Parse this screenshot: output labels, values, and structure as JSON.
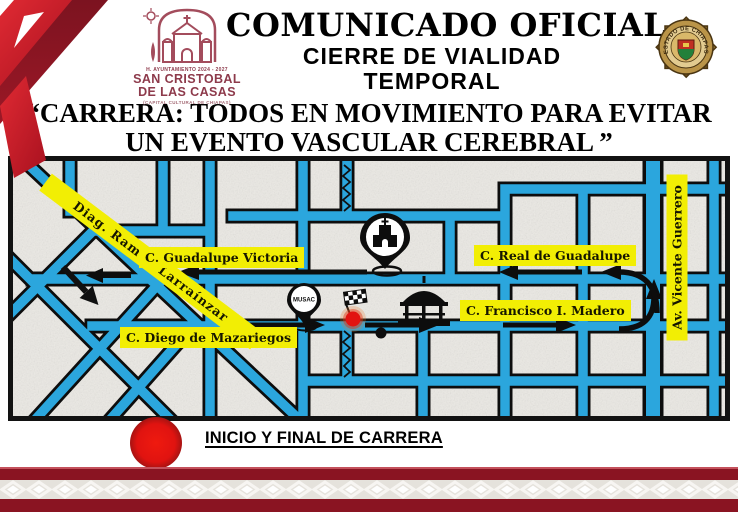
{
  "header": {
    "title": "COMUNICADO OFICIAL",
    "subtitle1": "CIERRE DE VIALIDAD",
    "subtitle2": "TEMPORAL"
  },
  "logo": {
    "admin": "H. AYUNTAMIENTO 2024 - 2027",
    "city1": "SAN CRISTOBAL",
    "city2": "DE LAS CASAS",
    "tagline": "(CAPITAL CULTURAL DE CHIAPAS)"
  },
  "badge": {
    "arc_text": "ESTADO DE CHIAPAS"
  },
  "event": {
    "line1": "“CARRERA: TODOS EN MOVIMIENTO PARA EVITAR",
    "line2": "UN EVENTO VASCULAR CEREBRAL ”"
  },
  "map": {
    "labels": {
      "larrainzar": "Diag. Ramón Larraínzar",
      "victoria": "C. Guadalupe Victoria",
      "real": "C. Real de Guadalupe",
      "madero": "C. Francisco I. Madero",
      "mazariegos": "C. Diego de Mazariegos",
      "guerrero": "Av. Vicente Guerrero"
    },
    "musac": "MUSAC",
    "colors": {
      "street": "#2BA6DD",
      "label_bg": "#F2EE04",
      "block": "#EBE9E4"
    }
  },
  "legend": {
    "text": "INICIO Y FINAL DE CARRERA",
    "dot_color": "#E21310"
  },
  "colors": {
    "maroon": "#8A1422",
    "red": "#CE2130"
  }
}
